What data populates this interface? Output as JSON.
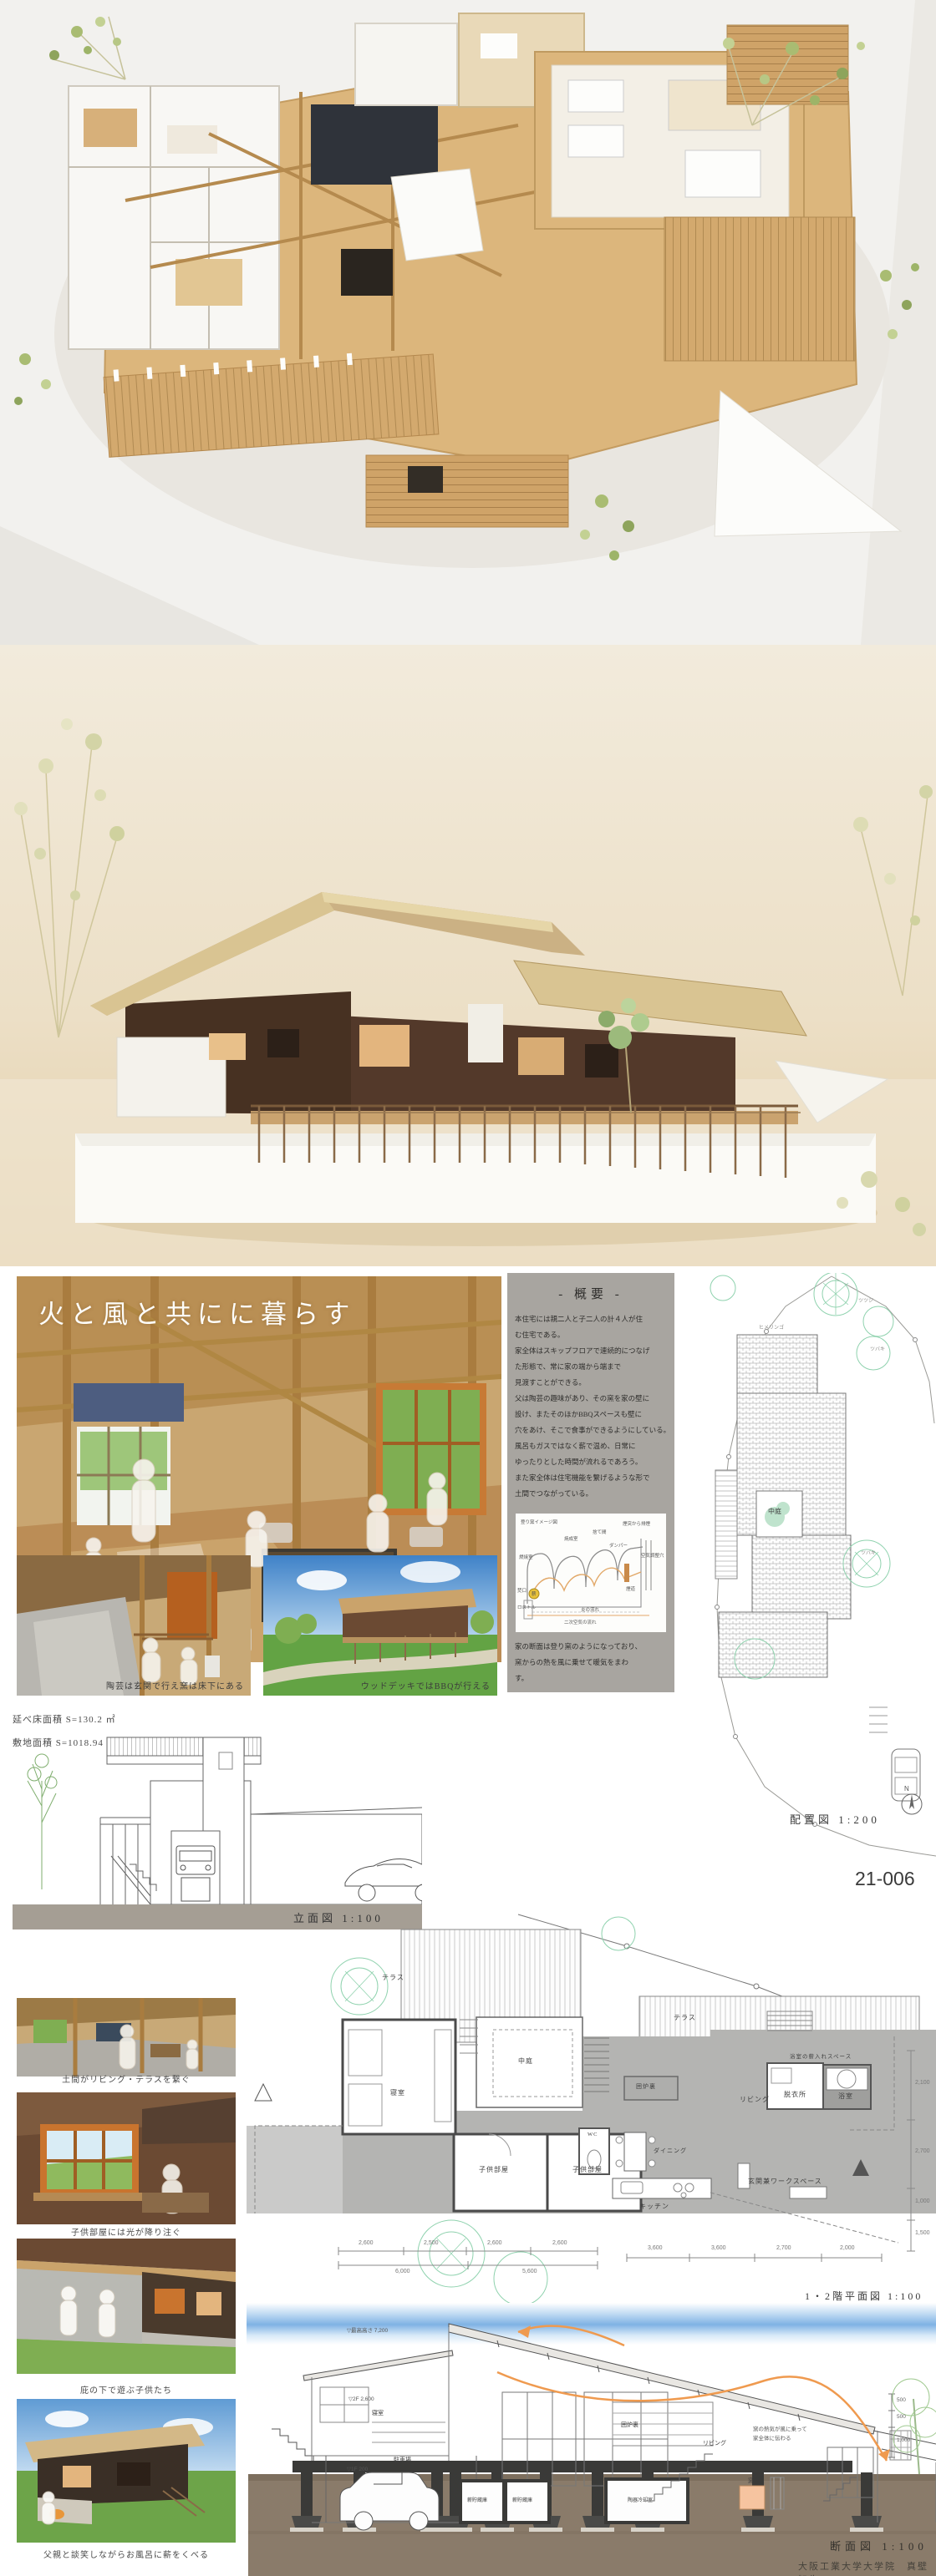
{
  "board": {
    "title": "火と風と共にに暮らす",
    "overview": {
      "heading": "- 概要 -",
      "lines": [
        "本住宅には親二人と子二人の計４人が住",
        "む住宅である。",
        "家全体はスキップフロアで連続的につなげ",
        "た形態で、常に家の端から端まで",
        "見渡すことができる。",
        "父は陶芸の趣味があり、その窯を家の壁に",
        "設け、またそのほかBBQスペースも壁に",
        "穴をあけ、そこで食事ができるようにしている。",
        "風呂もガスではなく薪で温め、日常に",
        "ゆったりとした時間が流れるであろう。",
        "また家全体は住宅機能を繋げるような形で",
        "土間でつながっている。"
      ],
      "closing_lines": [
        "家の断面は登り窯のようになっており、",
        "窯からの熱を風に乗せて暖気をまわ",
        "す。"
      ],
      "diagram": {
        "title": "登り窯イメージ図",
        "labels": {
          "firebox": "燃焼室",
          "firing_chamber": "焼成室",
          "sutema": "捨て間",
          "damper": "ダンパー",
          "chimney_exhaust": "煙突から排煙",
          "air_hole": "空気調整穴",
          "flue": "煙道",
          "stoke_hole": "焚口",
          "firewood": "薪",
          "grate": "ロストル",
          "flame_flow": "炎の流れ",
          "secondary_air": "二次空気の流れ"
        }
      }
    },
    "area_notes": {
      "floor": "延べ床面積 S=130.2 ㎡",
      "site": "敷地面積 S=1018.94 ㎡"
    },
    "captions": {
      "pottery": "陶芸は玄関で行え窯は床下にある",
      "deck_bbq": "ウッドデッキではBBQが行える",
      "doma": "土間がリビング・テラスを繋ぐ",
      "kids_light": "子供部屋には光が降り注ぐ",
      "eaves_play": "庇の下で遊ぶ子供たち",
      "bath_firewood": "父親と談笑しながらお風呂に薪をくべる"
    },
    "site_plan": {
      "label": "配置図 1:200",
      "sheet_no": "21-006",
      "north": "N",
      "courtyard": "中庭",
      "plants": [
        "ヒメリンゴ",
        "ツツジ",
        "ツバキ",
        "ツバキ"
      ]
    },
    "elevation": {
      "label": "立面図 1:100"
    },
    "floor_plan": {
      "label": "1・2階平面図 1:100",
      "rooms": [
        "テラス",
        "中庭",
        "寝室",
        "囲炉裏",
        "テラス",
        "リビング",
        "脱衣所",
        "浴室",
        "浴室の薪入れスペース",
        "子供部屋",
        "子供部屋",
        "WC",
        "ダイニング",
        "キッチン",
        "玄関兼ワークスペース"
      ],
      "dims_right": [
        "2,100",
        "2,700",
        "1,000",
        "1,500"
      ],
      "dims_bottom": [
        "2,600",
        "2,500",
        "2,600",
        "2,600",
        "3,600",
        "3,600",
        "2,700",
        "2,000"
      ],
      "dims_totals": [
        "6,000",
        "5,600"
      ]
    },
    "section": {
      "label": "断面図 1:100",
      "rooms": [
        "寝室",
        "駐車場",
        "薪貯蔵庫",
        "薪貯蔵庫",
        "陶器冷却室",
        "囲炉裏",
        "リビング",
        "窯"
      ],
      "note_lines": [
        "窯の熱気が風に乗って",
        "家全体に伝わる"
      ],
      "levels": [
        "▽最高高さ 7,200",
        "▽2F 2,600",
        "▽1F 200"
      ],
      "dims": [
        "500",
        "500",
        "1,000"
      ]
    },
    "credit": "大阪工業大学大学院　真壁智生"
  },
  "colors": {
    "overview_panel": "#a8a5a0",
    "plan_gray": "#b4b4b2",
    "ground_brown": "#8a7b6a",
    "airflow_orange": "#ef9a4f",
    "sky_band_blue": "#7fb2e4",
    "model_wood": "#d8b277",
    "model_wall_dark": "#53392a"
  }
}
